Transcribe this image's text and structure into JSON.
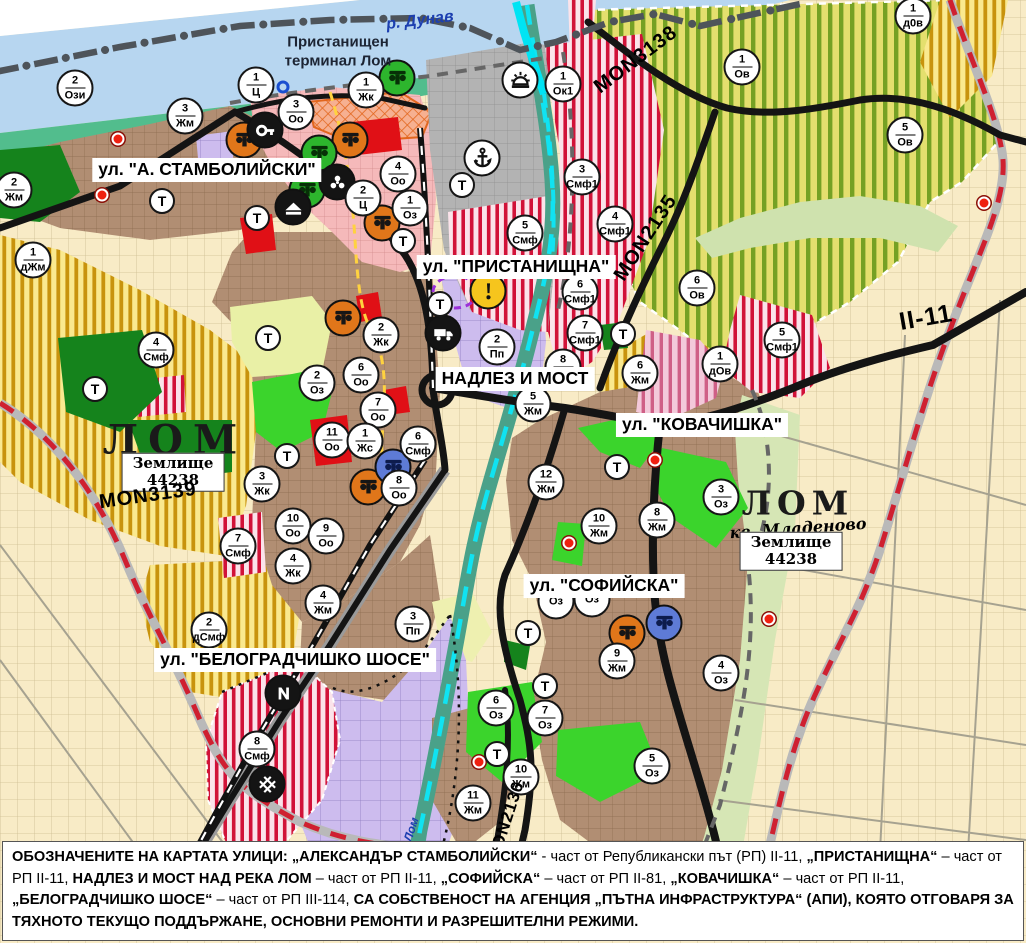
{
  "map": {
    "t_symbol": "Т",
    "colors": {
      "danube_blue": "#b7d6f0",
      "shore_green": "#52bd8d",
      "residential_brown": "#b18e73",
      "vineyard_yellow_green": "#e4df6e",
      "vineyard_stripe": "#75a124",
      "villa_gold": "#c8930d",
      "mixed_red_stripe": "#d11238",
      "production_purple": "#cdbcee",
      "center_pink": "#f5b9ba",
      "port_gray": "#b3b3b3",
      "park_green": "#3bd42c",
      "forest_green": "#15831c",
      "river_cyan": "#10e3f2",
      "road_black": "#141414",
      "road_red_dash": "#cf2030",
      "farmland_cream": "#f8ebc6"
    },
    "labels": [
      {
        "id": "street-stamboliyski",
        "t": "ул. \"А. СТАМБОЛИЙСКИ\"",
        "x": 207,
        "y": 170,
        "s": "street",
        "r": 0
      },
      {
        "id": "street-pristanishtna",
        "t": "ул. \"ПРИСТАНИЩНА\"",
        "x": 516,
        "y": 267,
        "s": "street",
        "r": 0
      },
      {
        "id": "street-nadlez-i-most",
        "t": "НАДЛЕЗ И МОСТ",
        "x": 515,
        "y": 379,
        "s": "street",
        "r": 0
      },
      {
        "id": "street-kovachishka",
        "t": "ул. \"КОВАЧИШКА\"",
        "x": 702,
        "y": 425,
        "s": "street",
        "r": 0
      },
      {
        "id": "street-sofiyska",
        "t": "ул. \"СОФИЙСКА\"",
        "x": 604,
        "y": 586,
        "s": "street",
        "r": 0
      },
      {
        "id": "street-belogradchishko-shose",
        "t": "ул. \"БЕЛОГРАДЧИШКО ШОСЕ\"",
        "x": 295,
        "y": 660,
        "s": "street",
        "r": 0
      },
      {
        "id": "port-terminal-label",
        "t": "Пристанищен\nтерминал Лом",
        "x": 338,
        "y": 52,
        "s": "terminal",
        "r": 0
      },
      {
        "id": "river-danube-label",
        "t": "р. Дунав",
        "x": 420,
        "y": 21,
        "s": "river",
        "r": -7
      },
      {
        "id": "river-lom-label",
        "t": "р. Лом",
        "x": 409,
        "y": 836,
        "s": "river-sm",
        "r": -72
      },
      {
        "id": "city-lom-label",
        "t": "ЛОМ",
        "x": 175,
        "y": 440,
        "s": "city",
        "r": 0
      },
      {
        "id": "zemlishte-44238-label-west",
        "t": "Землище\n44238",
        "x": 173,
        "y": 472,
        "s": "zem",
        "r": 0
      },
      {
        "id": "city-lom-mladenovo-label",
        "t": "ЛОМ",
        "x": 798,
        "y": 503,
        "s": "city2",
        "r": 0
      },
      {
        "id": "kv-mladenovo-label",
        "t": "кв. Младеново",
        "x": 798,
        "y": 528,
        "s": "citysub",
        "r": -4
      },
      {
        "id": "zemlishte-44238-label-east",
        "t": "Землище\n44238",
        "x": 791,
        "y": 551,
        "s": "zem",
        "r": 0
      },
      {
        "id": "road-mon3139-label",
        "t": "MON3139",
        "x": 148,
        "y": 496,
        "s": "road",
        "r": -8
      },
      {
        "id": "road-mon3138-label",
        "t": "MON3138",
        "x": 636,
        "y": 60,
        "s": "road",
        "r": -37
      },
      {
        "id": "road-mon2135-label",
        "t": "MON2135",
        "x": 646,
        "y": 238,
        "s": "road",
        "r": -57
      },
      {
        "id": "road-mon2136-label",
        "t": "MON2136",
        "x": 506,
        "y": 822,
        "s": "road-sm",
        "r": -72
      },
      {
        "id": "road-ii-11-label",
        "t": "II-11",
        "x": 926,
        "y": 318,
        "s": "highway",
        "r": -10
      }
    ],
    "zone_markers": [
      {
        "n": "2",
        "c": "Ози",
        "x": 75,
        "y": 88
      },
      {
        "n": "1",
        "c": "Ц",
        "x": 256,
        "y": 85
      },
      {
        "n": "3",
        "c": "Оо",
        "x": 296,
        "y": 112
      },
      {
        "n": "1",
        "c": "Жк",
        "x": 366,
        "y": 90
      },
      {
        "n": "3",
        "c": "Жм",
        "x": 185,
        "y": 116
      },
      {
        "n": "2",
        "c": "Жм",
        "x": 14,
        "y": 190
      },
      {
        "n": "1",
        "c": "дЖм",
        "x": 33,
        "y": 260
      },
      {
        "n": "4",
        "c": "Оо",
        "x": 398,
        "y": 174
      },
      {
        "n": "2",
        "c": "Ц",
        "x": 363,
        "y": 198
      },
      {
        "n": "1",
        "c": "Оз",
        "x": 410,
        "y": 208
      },
      {
        "n": "1",
        "c": "Ок1",
        "x": 563,
        "y": 84
      },
      {
        "n": "3",
        "c": "Смф1",
        "x": 582,
        "y": 177
      },
      {
        "n": "4",
        "c": "Смф1",
        "x": 615,
        "y": 224
      },
      {
        "n": "5",
        "c": "Смф",
        "x": 525,
        "y": 233
      },
      {
        "n": "6",
        "c": "Смф1",
        "x": 580,
        "y": 292
      },
      {
        "n": "7",
        "c": "Смф1",
        "x": 585,
        "y": 333
      },
      {
        "n": "2",
        "c": "Пп",
        "x": 497,
        "y": 347
      },
      {
        "n": "8",
        "c": "Жм",
        "x": 563,
        "y": 367
      },
      {
        "n": "5",
        "c": "Жм",
        "x": 533,
        "y": 404
      },
      {
        "n": "1",
        "c": "Ов",
        "x": 742,
        "y": 67
      },
      {
        "n": "5",
        "c": "Ов",
        "x": 905,
        "y": 135
      },
      {
        "n": "1",
        "c": "д0в",
        "x": 913,
        "y": 16
      },
      {
        "n": "6",
        "c": "Ов",
        "x": 697,
        "y": 288
      },
      {
        "n": "1",
        "c": "дОв",
        "x": 720,
        "y": 364
      },
      {
        "n": "5",
        "c": "Смф1",
        "x": 782,
        "y": 340
      },
      {
        "n": "6",
        "c": "Жм",
        "x": 640,
        "y": 373
      },
      {
        "n": "12",
        "c": "Жм",
        "x": 546,
        "y": 482
      },
      {
        "n": "10",
        "c": "Жм",
        "x": 599,
        "y": 526
      },
      {
        "n": "8",
        "c": "Жм",
        "x": 657,
        "y": 520
      },
      {
        "n": "3",
        "c": "Оз",
        "x": 721,
        "y": 497
      },
      {
        "n": "4",
        "c": "Оз",
        "x": 721,
        "y": 673
      },
      {
        "n": "9",
        "c": "Жм",
        "x": 617,
        "y": 661
      },
      {
        "n": "5",
        "c": "Оз",
        "x": 652,
        "y": 766
      },
      {
        "n": "6",
        "c": "Оз",
        "x": 496,
        "y": 708
      },
      {
        "n": "7",
        "c": "Оз",
        "x": 545,
        "y": 718
      },
      {
        "n": "10",
        "c": "Жм",
        "x": 521,
        "y": 777
      },
      {
        "n": "11",
        "c": "Жм",
        "x": 473,
        "y": 803
      },
      {
        "n": "2",
        "c": "Жк",
        "x": 381,
        "y": 335
      },
      {
        "n": "6",
        "c": "Оо",
        "x": 361,
        "y": 375
      },
      {
        "n": "7",
        "c": "Оо",
        "x": 378,
        "y": 410
      },
      {
        "n": "2",
        "c": "Оз",
        "x": 317,
        "y": 383
      },
      {
        "n": "11",
        "c": "Оо",
        "x": 332,
        "y": 440
      },
      {
        "n": "1",
        "c": "Жс",
        "x": 365,
        "y": 441
      },
      {
        "n": "6",
        "c": "Смф",
        "x": 418,
        "y": 444
      },
      {
        "n": "3",
        "c": "Жк",
        "x": 262,
        "y": 484
      },
      {
        "n": "8",
        "c": "Оо",
        "x": 399,
        "y": 488
      },
      {
        "n": "10",
        "c": "Оо",
        "x": 293,
        "y": 526
      },
      {
        "n": "9",
        "c": "Оо",
        "x": 326,
        "y": 536
      },
      {
        "n": "7",
        "c": "Смф",
        "x": 238,
        "y": 546
      },
      {
        "n": "4",
        "c": "Смф",
        "x": 156,
        "y": 350
      },
      {
        "n": "4",
        "c": "Жк",
        "x": 293,
        "y": 566
      },
      {
        "n": "4",
        "c": "Жм",
        "x": 323,
        "y": 603
      },
      {
        "n": "3",
        "c": "Пп",
        "x": 413,
        "y": 624
      },
      {
        "n": "2",
        "c": "дСмф",
        "x": 209,
        "y": 630
      },
      {
        "n": "8",
        "c": "Смф",
        "x": 257,
        "y": 749
      },
      {
        "n": "",
        "c": "Оз",
        "x": 556,
        "y": 601
      },
      {
        "n": "",
        "c": "Оз",
        "x": 592,
        "y": 599
      }
    ],
    "t_markers": [
      [
        162,
        201
      ],
      [
        257,
        218
      ],
      [
        403,
        241
      ],
      [
        462,
        185
      ],
      [
        440,
        304
      ],
      [
        623,
        334
      ],
      [
        95,
        389
      ],
      [
        268,
        338
      ],
      [
        287,
        456
      ],
      [
        617,
        467
      ],
      [
        528,
        633
      ],
      [
        545,
        686
      ],
      [
        497,
        754
      ]
    ],
    "icon_markers": [
      {
        "i": "capital",
        "x": 244,
        "y": 140,
        "bg": "#e0761a",
        "fg": "#161616"
      },
      {
        "i": "capital",
        "x": 350,
        "y": 140,
        "bg": "#e0761a",
        "fg": "#161616"
      },
      {
        "i": "capital",
        "x": 382,
        "y": 223,
        "bg": "#e0761a",
        "fg": "#161616"
      },
      {
        "i": "capital",
        "x": 343,
        "y": 318,
        "bg": "#e0761a",
        "fg": "#161616"
      },
      {
        "i": "capital",
        "x": 368,
        "y": 487,
        "bg": "#e0761a",
        "fg": "#161616"
      },
      {
        "i": "capital",
        "x": 627,
        "y": 633,
        "bg": "#e0761a",
        "fg": "#161616"
      },
      {
        "i": "capital",
        "x": 397,
        "y": 78,
        "bg": "#2db52d",
        "fg": "#073007"
      },
      {
        "i": "capital",
        "x": 319,
        "y": 153,
        "bg": "#2db52d",
        "fg": "#073007"
      },
      {
        "i": "capital",
        "x": 307,
        "y": 190,
        "bg": "#2db52d",
        "fg": "#073007"
      },
      {
        "i": "capital",
        "x": 393,
        "y": 467,
        "bg": "#5e7bd6",
        "fg": "#0d1c4e"
      },
      {
        "i": "capital",
        "x": 664,
        "y": 623,
        "bg": "#5e7bd6",
        "fg": "#0d1c4e"
      },
      {
        "i": "key",
        "x": 265,
        "y": 130,
        "bg": "#141414",
        "fg": "#ffffff"
      },
      {
        "i": "trefoil",
        "x": 337,
        "y": 182,
        "bg": "#141414",
        "fg": "#ffffff"
      },
      {
        "i": "home",
        "x": 293,
        "y": 207,
        "bg": "#141414",
        "fg": "#ffffff"
      },
      {
        "i": "truck",
        "x": 443,
        "y": 333,
        "bg": "#141414",
        "fg": "#ffffff"
      },
      {
        "i": "bolt",
        "x": 283,
        "y": 693,
        "bg": "#141414",
        "fg": "#ffffff"
      },
      {
        "i": "railcross",
        "x": 267,
        "y": 784,
        "bg": "#141414",
        "fg": "#ffffff"
      },
      {
        "i": "anchor",
        "x": 482,
        "y": 158,
        "bg": "#ffffff",
        "fg": "#111111"
      },
      {
        "i": "sun",
        "x": 520,
        "y": 80,
        "bg": "#ffffff",
        "fg": "#111111"
      },
      {
        "i": "exclaim",
        "x": 488,
        "y": 291,
        "bg": "#f6c51d",
        "fg": "#111111"
      }
    ],
    "red_dots": [
      [
        118,
        139
      ],
      [
        102,
        195
      ],
      [
        655,
        460
      ],
      [
        569,
        543
      ],
      [
        479,
        762
      ],
      [
        769,
        619
      ],
      [
        984,
        203
      ]
    ],
    "blue_dots": [
      [
        283,
        87
      ]
    ],
    "caption": {
      "segments": [
        {
          "t": "ОБОЗНАЧЕНИТЕ НА КАРТАТА УЛИЦИ: ",
          "b": true
        },
        {
          "t": "„АЛЕКСАНДЪР СТАМБОЛИЙСКИ“",
          "b": true
        },
        {
          "t": " - част от Републикански път (РП) II-11, ",
          "b": false
        },
        {
          "t": "„ПРИСТАНИЩНА“",
          "b": true
        },
        {
          "t": " – част от РП II-11, ",
          "b": false
        },
        {
          "t": "НАДЛЕЗ И МОСТ НАД РЕКА ЛОМ",
          "b": true
        },
        {
          "t": " – част от РП II-11, ",
          "b": false
        },
        {
          "t": "„СОФИЙСКА“",
          "b": true
        },
        {
          "t": " – част от РП II-81, ",
          "b": false
        },
        {
          "t": "„КОВАЧИШКА“",
          "b": true
        },
        {
          "t": " – част от РП II-11, ",
          "b": false
        },
        {
          "t": "„БЕЛОГРАДЧИШКО ШОСЕ“",
          "b": true
        },
        {
          "t": " – част от РП III-114, ",
          "b": false
        },
        {
          "t": "СА СОБСТВЕНОСТ НА АГЕНЦИЯ „ПЪТНА ИНФРАСТРУКТУРА“ (АПИ), КОЯТО ОТГОВАРЯ ЗА ТЯХНОТО ТЕКУЩО ПОДДЪРЖАНЕ, ОСНОВНИ РЕМОНТИ И РАЗРЕШИТЕЛНИ РЕЖИМИ.",
          "b": true
        }
      ]
    }
  }
}
